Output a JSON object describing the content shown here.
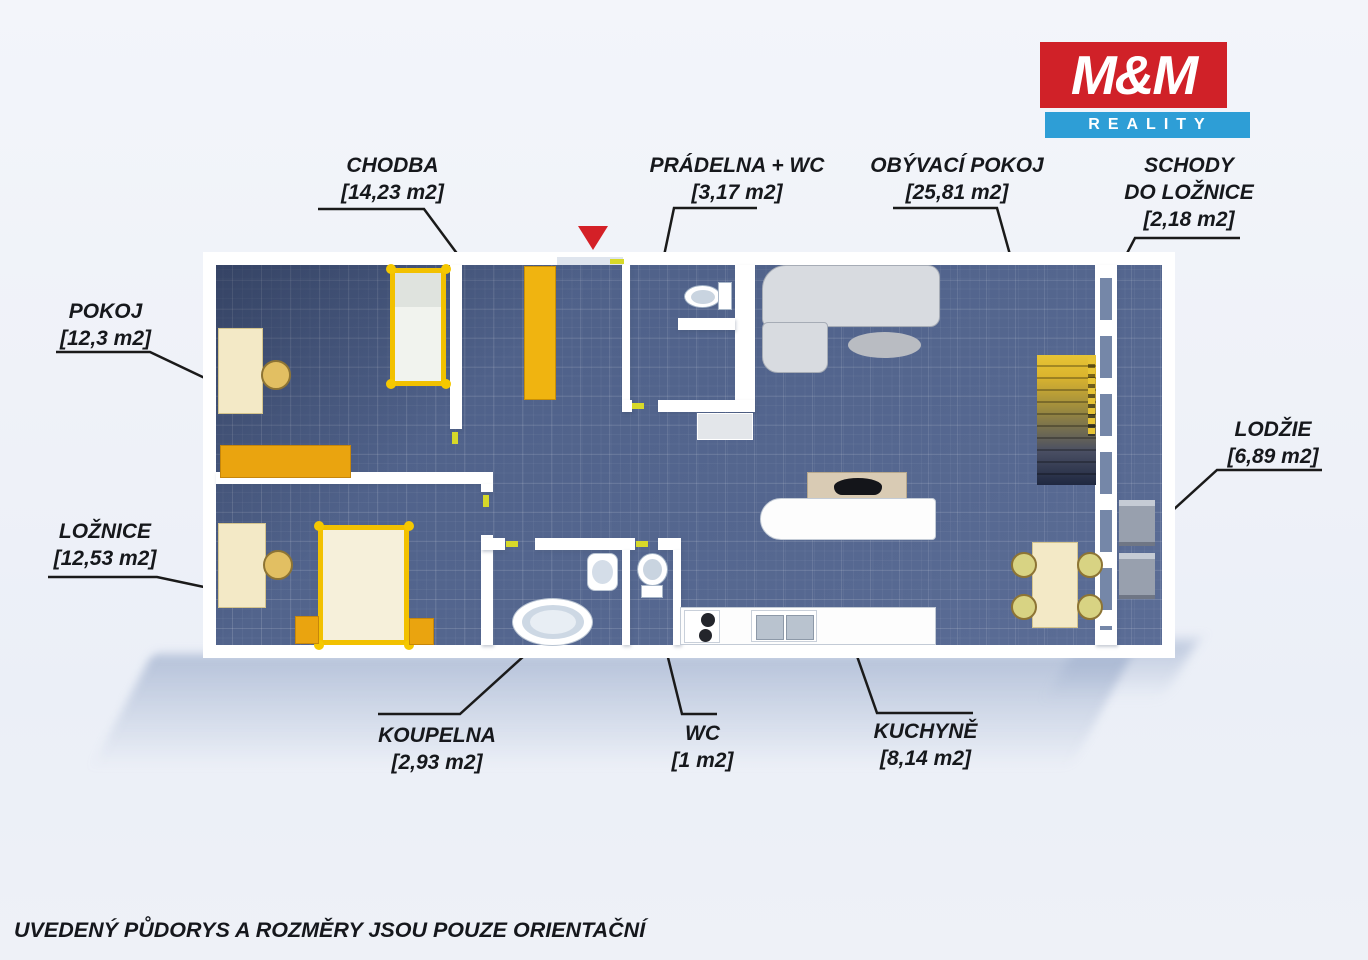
{
  "logo": {
    "top": "M&M",
    "bottom": "REALITY",
    "red": "#d02128",
    "blue": "#2e9ed6"
  },
  "rooms": [
    {
      "id": "chodba",
      "label": "CHODBA",
      "area": "[14,23 m2]"
    },
    {
      "id": "pradelna",
      "label": "PRÁDELNA + WC",
      "area": "[3,17 m2]"
    },
    {
      "id": "obyvaci",
      "label": "OBÝVACÍ POKOJ",
      "area": "[25,81 m2]"
    },
    {
      "id": "schody",
      "label": "SCHODY",
      "label2": "DO LOŽNICE",
      "area": "[2,18 m2]"
    },
    {
      "id": "pokoj",
      "label": "POKOJ",
      "area": "[12,3 m2]"
    },
    {
      "id": "loznice",
      "label": "LOŽNICE",
      "area": "[12,53 m2]"
    },
    {
      "id": "lodzie",
      "label": "LODŽIE",
      "area": "[6,89 m2]"
    },
    {
      "id": "koupelna",
      "label": "KOUPELNA",
      "area": "[2,93 m2]"
    },
    {
      "id": "wc",
      "label": "WC",
      "area": "[1 m2]"
    },
    {
      "id": "kuchyne",
      "label": "KUCHYNĚ",
      "area": "[8,14 m2]"
    }
  ],
  "disclaimer": "UVEDENÝ PŮDORYS A ROZMĚRY JSOU POUZE ORIENTAČNÍ",
  "colors": {
    "logo_red": "#d02128",
    "logo_blue": "#2e9ed6",
    "floor_blue": "#53658e",
    "furniture_yellow": "#f2c100",
    "furniture_orange": "#eaa40f",
    "furniture_cream": "#f3e9c6",
    "entrance_arrow_red": "#d42027",
    "label_text": "#16181c",
    "background": "#eef1f8"
  }
}
